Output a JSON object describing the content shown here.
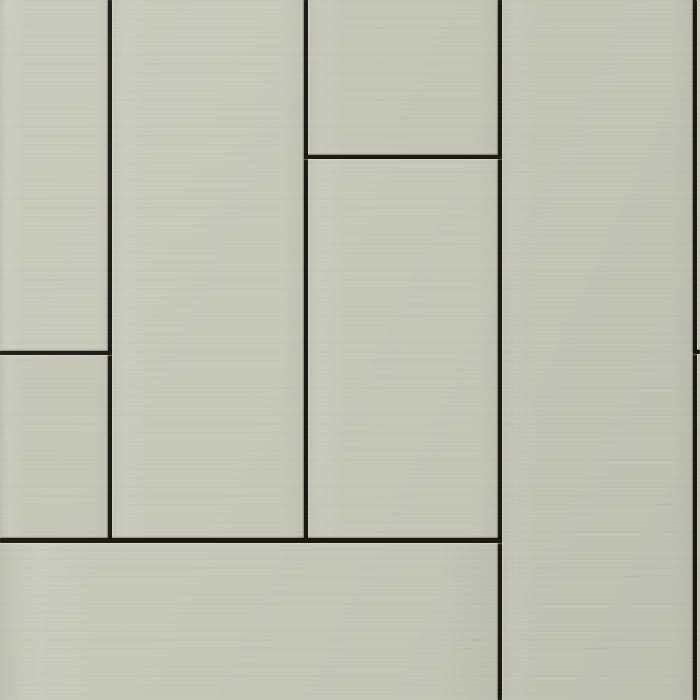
{
  "scene": {
    "description": "Seamless texture of pale sage-green facade cladding panels in a staggered vertical layout with recessed dark joints",
    "panel_color": "#c6c8ba",
    "panel_color_alt": "#c4c6b8",
    "seam_color": "#1a1811",
    "highlight_color": "#ebeDe0",
    "width": 700,
    "height": 700
  },
  "panels": [
    {
      "id": "panel-left-top",
      "x": 0,
      "y": 0,
      "w": 110,
      "h": 353
    },
    {
      "id": "panel-left-bottom",
      "x": 0,
      "y": 353,
      "w": 110,
      "h": 187
    },
    {
      "id": "panel-col2-full",
      "x": 110,
      "y": 0,
      "w": 196,
      "h": 540
    },
    {
      "id": "panel-col3-top",
      "x": 306,
      "y": 0,
      "w": 194,
      "h": 157
    },
    {
      "id": "panel-col3-bottom",
      "x": 306,
      "y": 157,
      "w": 194,
      "h": 383
    },
    {
      "id": "panel-col4-full",
      "x": 500,
      "y": 0,
      "w": 195,
      "h": 700
    },
    {
      "id": "panel-right-sliver-top",
      "x": 695,
      "y": 0,
      "w": 5,
      "h": 352
    },
    {
      "id": "panel-right-sliver-bottom",
      "x": 695,
      "y": 352,
      "w": 5,
      "h": 348
    },
    {
      "id": "panel-bottom-wide",
      "x": 0,
      "y": 540,
      "w": 500,
      "h": 160
    }
  ],
  "seams": [
    {
      "id": "vertical-seam-1",
      "orientation": "vertical",
      "x": 108,
      "y": 0,
      "w": 4,
      "h": 543
    },
    {
      "id": "vertical-seam-2",
      "orientation": "vertical",
      "x": 304,
      "y": 0,
      "w": 4,
      "h": 543
    },
    {
      "id": "vertical-seam-3",
      "orientation": "vertical",
      "x": 498,
      "y": 0,
      "w": 4,
      "h": 700
    },
    {
      "id": "vertical-seam-4",
      "orientation": "vertical",
      "x": 693,
      "y": 0,
      "w": 4,
      "h": 700
    },
    {
      "id": "horizontal-seam-left",
      "orientation": "horizontal",
      "x": 0,
      "y": 351,
      "w": 112,
      "h": 4
    },
    {
      "id": "horizontal-seam-col3",
      "orientation": "horizontal",
      "x": 304,
      "y": 155,
      "w": 198,
      "h": 4
    },
    {
      "id": "horizontal-seam-bottom",
      "orientation": "horizontal",
      "x": 0,
      "y": 538,
      "w": 502,
      "h": 5
    },
    {
      "id": "horizontal-seam-right",
      "orientation": "horizontal",
      "x": 693,
      "y": 350,
      "w": 7,
      "h": 4
    }
  ]
}
